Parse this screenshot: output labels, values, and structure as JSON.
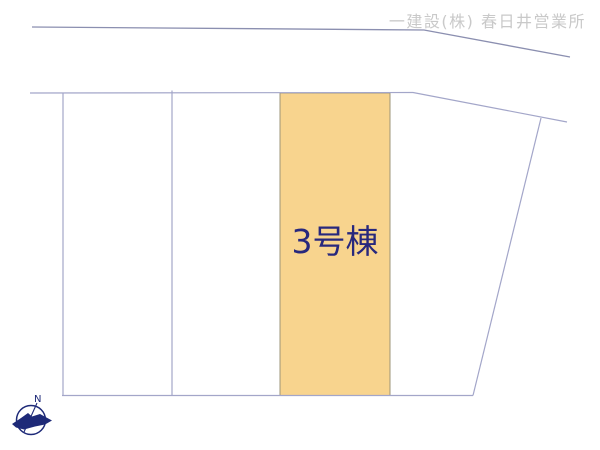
{
  "watermark": {
    "text": "一建設(株) 春日井営業所"
  },
  "site_plan": {
    "type": "residential-lot-layout",
    "highlighted_lot": {
      "label": "3号棟",
      "fill": "#f8d48e",
      "border": "#9c9478"
    },
    "lots": [
      {
        "id": "lot-1",
        "label": "",
        "highlighted": false
      },
      {
        "id": "lot-2",
        "label": "",
        "highlighted": false
      },
      {
        "id": "lot-3",
        "label": "3号棟",
        "highlighted": true
      },
      {
        "id": "lot-4",
        "label": "",
        "highlighted": false
      }
    ]
  },
  "compass": {
    "label": "N",
    "color": "#1e2a78"
  },
  "colors": {
    "background": "#ffffff",
    "lot_line": "#a3a6c9",
    "road_line": "#8b8fb0",
    "highlight_fill": "#f8d48e",
    "highlight_border": "#9c9478",
    "label_text": "#28287d",
    "watermark_text": "#c9c9c9",
    "compass_navy": "#1e2a78"
  }
}
